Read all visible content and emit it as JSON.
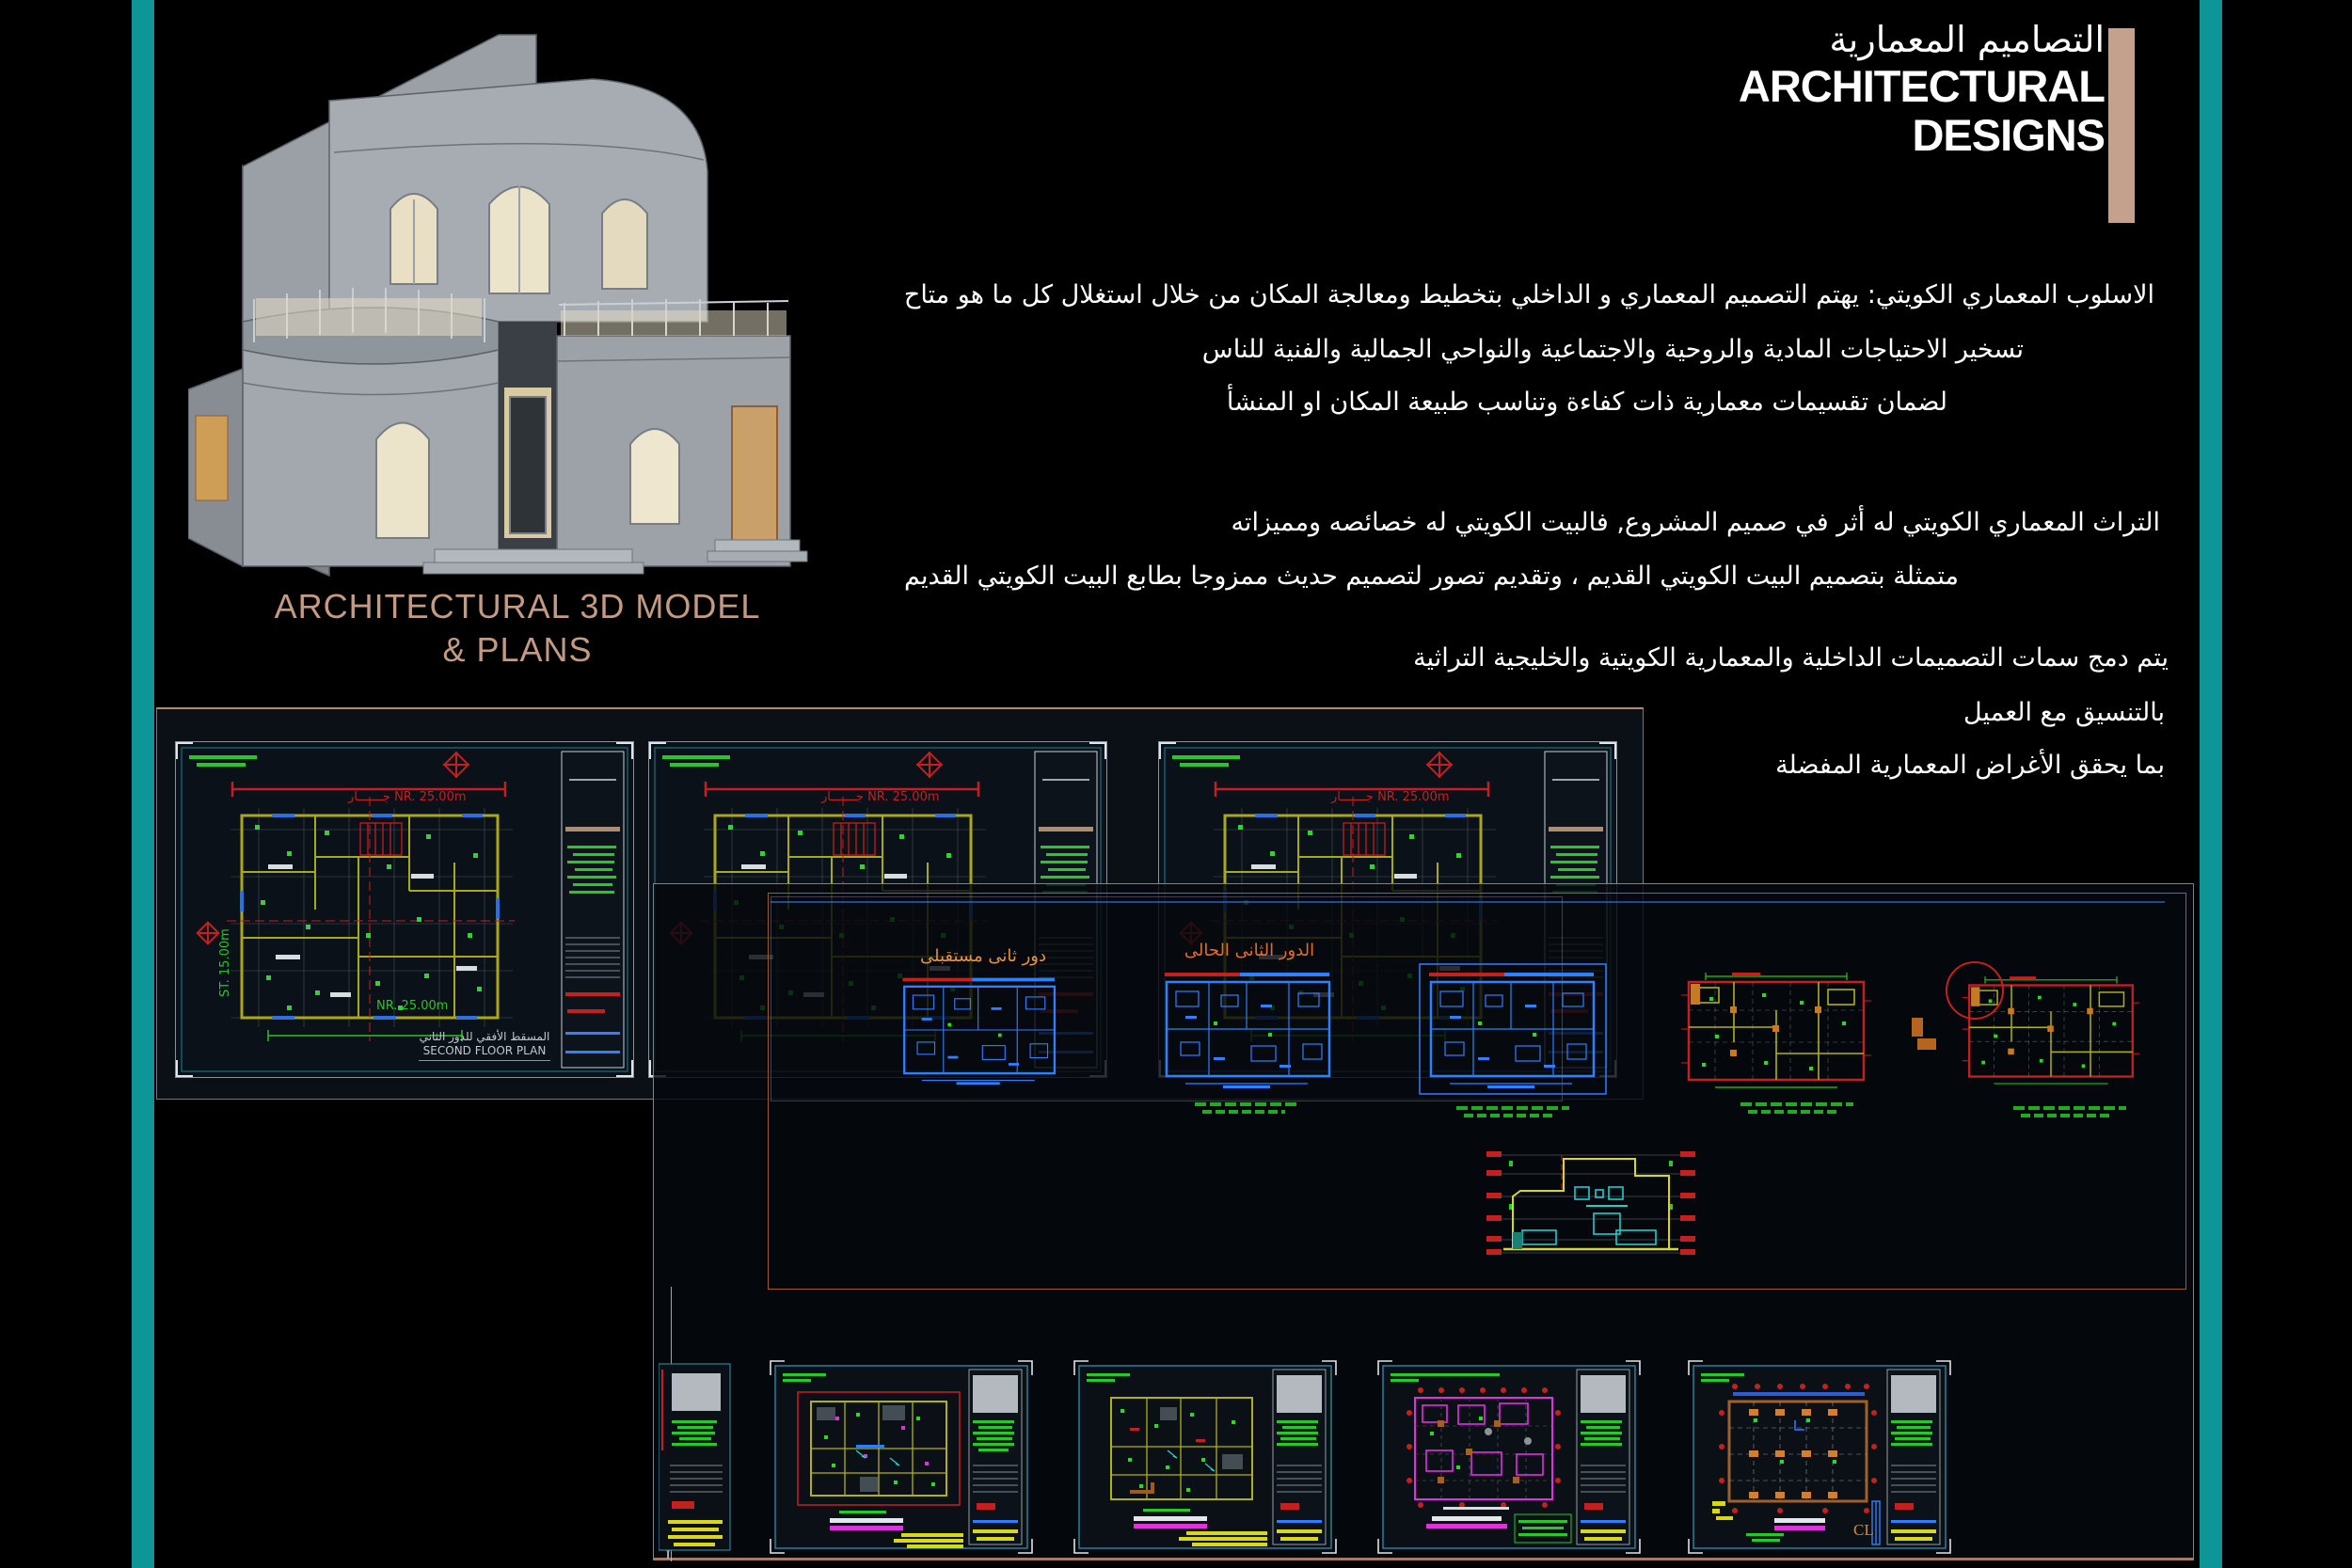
{
  "colors": {
    "teal_bar": "#0e9597",
    "tan_bar": "#c4a18c",
    "caption_tan": "#c49b82",
    "cad_red": "#cc1515",
    "cad_green": "#27c827",
    "cad_blue": "#2f7fff",
    "cad_yellow": "#d8d818",
    "cad_magenta": "#dd33dd",
    "cad_orange": "#c87a20"
  },
  "header": {
    "title_ar": "التصاميم المعمارية",
    "title_en_line1": "ARCHITECTURAL",
    "title_en_line2": "DESIGNS"
  },
  "model_caption": {
    "line1": "ARCHITECTURAL 3D MODEL",
    "line2": "& PLANS"
  },
  "intro": {
    "line1": "الاسلوب المعماري الكويتي: يهتم التصميم المعماري و الداخلي بتخطيط ومعالجة المكان من خلال استغلال كل ما هو متاح",
    "line2": "تسخير الاحتياجات المادية والروحية والاجتماعية والنواحي الجمالية والفنية للناس",
    "line3": "لضمان تقسيمات معمارية ذات كفاءة وتناسب طبيعة المكان او المنشأ"
  },
  "heritage": {
    "line1": "التراث المعماري الكويتي له أثر في صميم المشروع, فالبيت الكويتي له خصائصه ومميزاته",
    "line2": "متمثلة بتصميم البيت الكويتي القديم ، وتقديم تصور لتصميم حديث ممزوجا بطابع البيت الكويتي القديم"
  },
  "merge": {
    "line1": "يتم دمج سمات التصميمات الداخلية والمعمارية الكويتية والخليجية التراثية",
    "line2": "بالتنسيق مع العميل",
    "line3": "بما يحقق الأغراض المعمارية المفضلة"
  },
  "cad": {
    "top_sheet": {
      "dim_top": "جـــــــار  NR. 25.00m",
      "dim_bottom": "NR. 25.00m",
      "dim_side": "ST. 15.00m",
      "title_ar": "المسقط الأفقي للدور الثاني",
      "title_en": "SECOND FLOOR PLAN"
    },
    "blue_plans": {
      "future_label": "دور ثانى مستقبلى",
      "current_label": "الدور الثانى الحالى"
    },
    "foundation": {
      "cl": "CL"
    },
    "y_mark": "Y"
  }
}
